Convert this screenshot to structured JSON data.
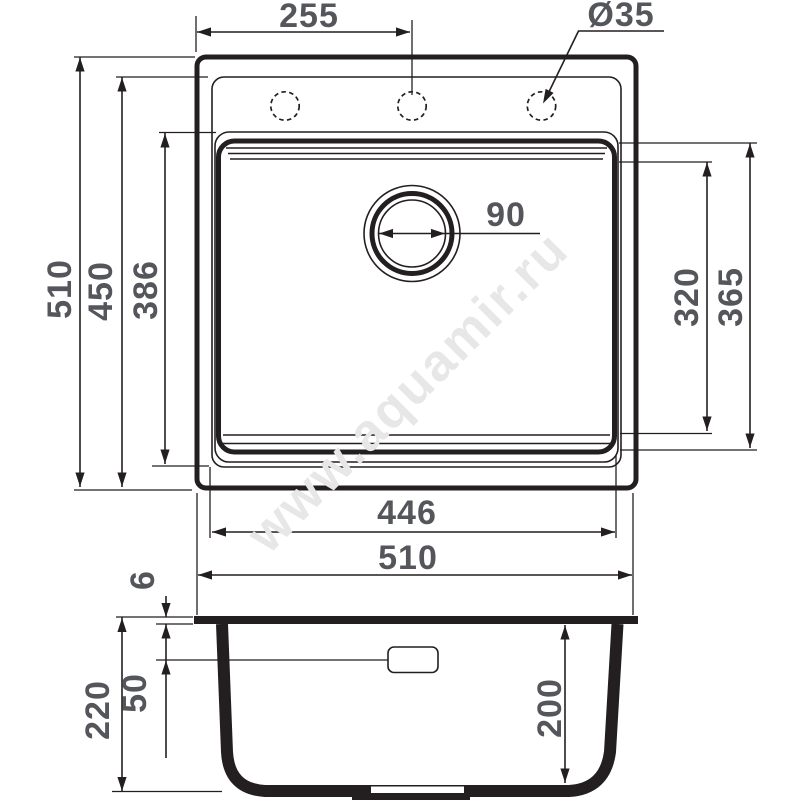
{
  "drawing": {
    "background": "#ffffff",
    "line_color": "#231f20",
    "dim_text_color": "#55565c"
  },
  "watermark": {
    "text": "www.aquamir.ru",
    "color": "#e7e7e7"
  },
  "top_view": {
    "labels": {
      "faucet_hole_offset": "255",
      "faucet_hole_diameter": "Ø35",
      "drain_diameter": "90",
      "overall_height": "510",
      "inner_rim_height": "450",
      "bowl_height": "386",
      "bowl_inner_depth_1": "320",
      "bowl_inner_depth_2": "365",
      "bowl_width": "446",
      "overall_width": "510"
    }
  },
  "section_view": {
    "labels": {
      "rim_thickness": "6",
      "overflow_offset": "50",
      "total_depth": "220",
      "bowl_depth": "200"
    }
  }
}
